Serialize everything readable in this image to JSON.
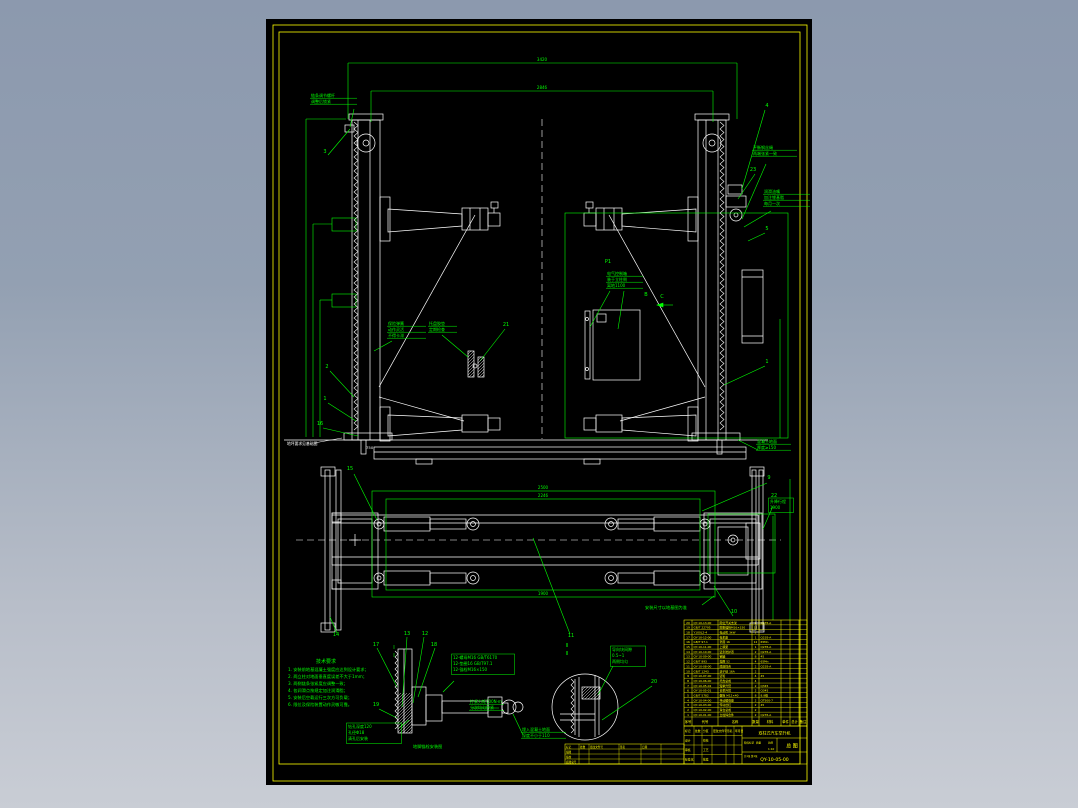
{
  "colors": {
    "background_top": "#8c99ae",
    "background_bottom": "#c9cdd5",
    "sheet": "#000000",
    "geometry": "#ffffff",
    "annotation": "#00ff00",
    "frame": "#ffff00"
  },
  "dims": [
    {
      "x": 276,
      "y": 42,
      "t": "3420"
    },
    {
      "x": 276,
      "y": 70,
      "t": "2846"
    },
    {
      "x": 277,
      "y": 470,
      "t": "2500"
    },
    {
      "x": 277,
      "y": 478,
      "t": "2246"
    },
    {
      "x": 277,
      "y": 576,
      "t": "1900"
    }
  ],
  "callouts": [
    {
      "x": 59,
      "y": 134,
      "t": "3"
    },
    {
      "x": 501,
      "y": 88,
      "t": "4"
    },
    {
      "x": 487,
      "y": 152,
      "t": "23"
    },
    {
      "x": 501,
      "y": 211,
      "t": "5"
    },
    {
      "x": 501,
      "y": 344,
      "t": "1"
    },
    {
      "x": 240,
      "y": 307,
      "t": "21"
    },
    {
      "x": 61,
      "y": 349,
      "t": "2"
    },
    {
      "x": 59,
      "y": 381,
      "t": "1"
    },
    {
      "x": 54,
      "y": 406,
      "t": "16"
    },
    {
      "x": 84,
      "y": 451,
      "t": "15"
    },
    {
      "x": 503,
      "y": 460,
      "t": "9"
    },
    {
      "x": 508,
      "y": 478,
      "t": "22"
    },
    {
      "x": 468,
      "y": 594,
      "t": "10"
    },
    {
      "x": 305,
      "y": 618,
      "t": "11"
    },
    {
      "x": 159,
      "y": 616,
      "t": "12"
    },
    {
      "x": 141,
      "y": 616,
      "t": "13"
    },
    {
      "x": 70,
      "y": 617,
      "t": "14"
    },
    {
      "x": 110,
      "y": 627,
      "t": "17"
    },
    {
      "x": 168,
      "y": 627,
      "t": "18"
    },
    {
      "x": 110,
      "y": 687,
      "t": "19"
    },
    {
      "x": 388,
      "y": 664,
      "t": "20"
    },
    {
      "x": 380,
      "y": 277,
      "t": "B"
    },
    {
      "x": 396,
      "y": 279,
      "t": "C"
    },
    {
      "x": 342,
      "y": 244,
      "t": "P1"
    },
    {
      "x": 128,
      "y": 630,
      "t": "I"
    },
    {
      "x": 128,
      "y": 638,
      "t": "I"
    },
    {
      "x": 301,
      "y": 628,
      "t": "II"
    },
    {
      "x": 301,
      "y": 636,
      "t": "II"
    }
  ],
  "labels": [
    {
      "x": 45,
      "y": 78,
      "w": 46,
      "box": false,
      "lines": [
        "链条调节螺杆",
        "调整后锁紧"
      ]
    },
    {
      "x": 487,
      "y": 130,
      "w": 44,
      "box": false,
      "lines": [
        "平衡钢丝绳",
        "两端张紧一致"
      ]
    },
    {
      "x": 498,
      "y": 174,
      "w": 46,
      "box": false,
      "lines": [
        "润滑油嘴",
        "加注锂基脂",
        "每月一次"
      ]
    },
    {
      "x": 122,
      "y": 306,
      "w": 38,
      "box": false,
      "lines": [
        "保险弹簧",
        "动作灵活",
        "不得卡滞"
      ]
    },
    {
      "x": 163,
      "y": 306,
      "w": 28,
      "box": false,
      "lines": [
        "托盘胶垫",
        "定期检查"
      ]
    },
    {
      "x": 341,
      "y": 256,
      "w": 36,
      "box": false,
      "lines": [
        "电气控制箱",
        "装于立柱侧",
        "离地1100"
      ]
    },
    {
      "x": 491,
      "y": 424,
      "w": 34,
      "box": false,
      "lines": [
        "混凝土地面",
        "厚度≥150"
      ]
    },
    {
      "x": 504,
      "y": 484,
      "w": 22,
      "box": true,
      "lines": [
        "升降行程",
        "1900"
      ]
    },
    {
      "x": 346,
      "y": 632,
      "w": 32,
      "box": true,
      "lines": [
        "导向块间隙",
        "0.5~1",
        "两侧均匀"
      ]
    },
    {
      "x": 187,
      "y": 640,
      "w": 60,
      "box": true,
      "lines": [
        "12-螺母M16 GB/T6170",
        "12-垫圈16 GB/T97.1",
        "12-锚栓M16×150"
      ]
    },
    {
      "x": 82,
      "y": 709,
      "w": 52,
      "box": true,
      "lines": [
        "钻孔深度120",
        "孔径Φ18",
        "清孔后安装"
      ]
    },
    {
      "x": 204,
      "y": 684,
      "w": 34,
      "box": false,
      "lines": [
        "拧紧力矩100N·m",
        "分次均匀拧紧"
      ]
    },
    {
      "x": 256,
      "y": 712,
      "w": 44,
      "box": false,
      "lines": [
        "埋入混凝土地面",
        "深度不小于110"
      ]
    }
  ],
  "notes": {
    "heading": "技术要求",
    "lines": [
      "1. 安装前地基混凝土强度应达到设计要求；",
      "2. 两立柱对地面垂直度误差不大于1mm；",
      "3. 两侧链条张紧度应调整一致；",
      "4. 各润滑点按规定加注润滑脂；",
      "5. 安装后空载运行三次方可负载；",
      "6. 限位及保险装置动作灵敏可靠。"
    ]
  },
  "misc_texts": {
    "floor_note": "地坪要求见基础图",
    "floor_dim": "750",
    "plan_note": "安装尺寸以地基图为准",
    "anchor_caption": "地脚锚栓安装图"
  },
  "bom": {
    "header": [
      "序号",
      "代号",
      "名称",
      "数量",
      "材料",
      "单件",
      "总计",
      "备注"
    ],
    "rows": [
      {
        "seq": "20",
        "code": "QY-10-13-00",
        "name": "限位开关支架",
        "qty": "2",
        "mat": "Q235-A",
        "w1": "",
        "w2": "",
        "rem": ""
      },
      {
        "seq": "19",
        "code": "GB/T 22795",
        "name": "膨胀锚栓M16×150",
        "qty": "12",
        "mat": "",
        "w1": "",
        "w2": "",
        "rem": ""
      },
      {
        "seq": "18",
        "code": "Y100L2-4",
        "name": "电动机 3kW",
        "qty": "2",
        "mat": "",
        "w1": "",
        "w2": "",
        "rem": ""
      },
      {
        "seq": "17",
        "code": "QY-10-12-00",
        "name": "电机座",
        "qty": "1",
        "mat": "Q235-A",
        "w1": "",
        "w2": "",
        "rem": ""
      },
      {
        "seq": "16",
        "code": "GB/T 97.1",
        "name": "垫圈 16",
        "qty": "12",
        "mat": "65Mn",
        "w1": "",
        "w2": "",
        "rem": ""
      },
      {
        "seq": "15",
        "code": "QY-10-11-00",
        "name": "上横梁",
        "qty": "1",
        "mat": "Q235-A",
        "w1": "",
        "w2": "",
        "rem": ""
      },
      {
        "seq": "14",
        "code": "QY-10-10-00",
        "name": "链条防护罩",
        "qty": "2",
        "mat": "Q235-A",
        "w1": "",
        "w2": "",
        "rem": ""
      },
      {
        "seq": "13",
        "code": "QY-10-09-00",
        "name": "销轴",
        "qty": "8",
        "mat": "45",
        "w1": "",
        "w2": "",
        "rem": ""
      },
      {
        "seq": "12",
        "code": "GB/T 893",
        "name": "挡圈 52",
        "qty": "4",
        "mat": "65Mn",
        "w1": "",
        "w2": "",
        "rem": ""
      },
      {
        "seq": "11",
        "code": "QY-10-08-00",
        "name": "底座焊合",
        "qty": "2",
        "mat": "Q235-A",
        "w1": "",
        "w2": "",
        "rem": ""
      },
      {
        "seq": "10",
        "code": "GB/T 1243",
        "name": "滚子链 16A",
        "qty": "2",
        "mat": "",
        "w1": "",
        "w2": "",
        "rem": ""
      },
      {
        "seq": "9",
        "code": "QY-10-07-00",
        "name": "链轮",
        "qty": "4",
        "mat": "45",
        "w1": "",
        "w2": "",
        "rem": ""
      },
      {
        "seq": "8",
        "code": "QY-10-06-00",
        "name": "托盘总成",
        "qty": "4",
        "mat": "",
        "w1": "",
        "w2": "",
        "rem": ""
      },
      {
        "seq": "7",
        "code": "QY-10-05-02",
        "name": "短举升臂",
        "qty": "2",
        "mat": "Q345",
        "w1": "",
        "w2": "",
        "rem": ""
      },
      {
        "seq": "6",
        "code": "QY-10-05-01",
        "name": "长举升臂",
        "qty": "2",
        "mat": "Q345",
        "w1": "",
        "w2": "",
        "rem": ""
      },
      {
        "seq": "5",
        "code": "GB/T 5782",
        "name": "螺栓 M12×40",
        "qty": "8",
        "mat": "8.8级",
        "w1": "",
        "w2": "",
        "rem": ""
      },
      {
        "seq": "4",
        "code": "QY-10-04-00",
        "name": "传动螺母座",
        "qty": "2",
        "mat": "QT500-7",
        "w1": "",
        "w2": "",
        "rem": ""
      },
      {
        "seq": "3",
        "code": "QY-10-03-00",
        "name": "传动丝杠",
        "qty": "2",
        "mat": "45",
        "w1": "",
        "w2": "",
        "rem": ""
      },
      {
        "seq": "2",
        "code": "QY-10-02-00",
        "name": "滑台总成",
        "qty": "2",
        "mat": "",
        "w1": "",
        "w2": "",
        "rem": ""
      },
      {
        "seq": "1",
        "code": "QY-10-01-00",
        "name": "立柱焊合件",
        "qty": "2",
        "mat": "Q235-A",
        "w1": "",
        "w2": "",
        "rem": ""
      }
    ]
  },
  "title_block": {
    "product": "双柱式汽车举升机",
    "type": "总 图",
    "no": "QY-10-05-00",
    "stage_labels": [
      "阶段标记",
      "质量",
      "比例"
    ],
    "scale": "1:10",
    "sheet_info": "共1张 第1张",
    "grid": [
      [
        "标记",
        "处数",
        "分区",
        "更改文件号",
        "签名",
        "年月日"
      ],
      [
        "设计",
        "",
        "校核",
        "",
        "",
        ""
      ],
      [
        "审核",
        "",
        "工艺",
        "",
        "",
        ""
      ],
      [
        "标准化",
        "",
        "批准",
        "",
        "",
        ""
      ]
    ]
  },
  "sig_strip": {
    "rows": [
      [
        "标记",
        "处数",
        "更改文件号",
        "签名",
        "日期"
      ],
      [
        "描图",
        "",
        "",
        "",
        ""
      ],
      [
        "描校",
        "",
        "",
        "",
        ""
      ],
      [
        "底图总号",
        "",
        "",
        "",
        ""
      ]
    ]
  }
}
